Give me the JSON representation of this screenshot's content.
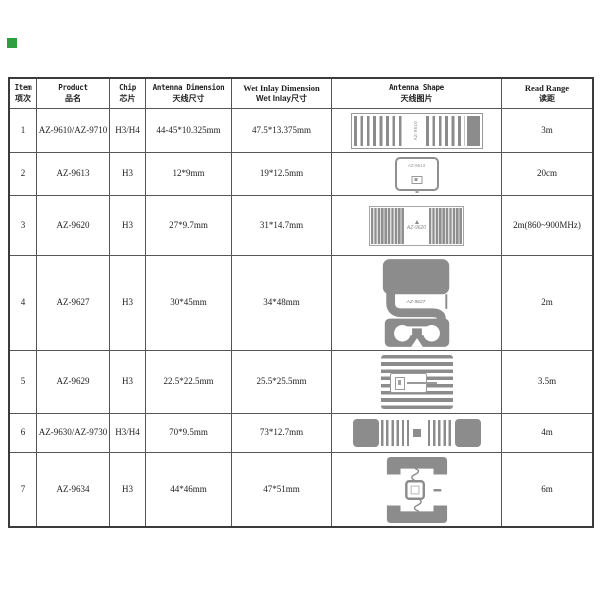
{
  "page": {
    "background": "#ffffff",
    "marker_color": "#2e9e40"
  },
  "table": {
    "headers": [
      {
        "en": "Item",
        "zh": "项次"
      },
      {
        "en": "Product",
        "zh": "品名"
      },
      {
        "en": "Chip",
        "zh": "芯片"
      },
      {
        "en": "Antenna Dimension",
        "zh": "天线尺寸"
      },
      {
        "en": "Wet Inlay Dimension",
        "zh": "Wet Inlay尺寸"
      },
      {
        "en": "Antenna Shape",
        "zh": "天线图片"
      },
      {
        "en": "Read Range",
        "zh": "读距"
      }
    ],
    "rows": [
      {
        "item": "1",
        "product": "AZ-9610/AZ-9710",
        "chip": "H3/H4",
        "antenna_dimension": "44-45*10.325mm",
        "wet_inlay_dimension": "47.5*13.375mm",
        "shape": "striped-dipole-inlay",
        "shape_label": "AZ-9610",
        "read_range": "3m"
      },
      {
        "item": "2",
        "product": "AZ-9613",
        "chip": "H3",
        "antenna_dimension": "12*9mm",
        "wet_inlay_dimension": "19*12.5mm",
        "shape": "small-rounded-square-tag",
        "shape_label": "AZ-9613",
        "read_range": "20cm"
      },
      {
        "item": "3",
        "product": "AZ-9620",
        "chip": "H3",
        "antenna_dimension": "27*9.7mm",
        "wet_inlay_dimension": "31*14.7mm",
        "shape": "dense-striped-rectangle",
        "shape_label": "AZ-9620",
        "read_range": "2m(860~900MHz)"
      },
      {
        "item": "4",
        "product": "AZ-9627",
        "chip": "H3",
        "antenna_dimension": "30*45mm",
        "wet_inlay_dimension": "34*48mm",
        "shape": "vertical-serpentine-tag",
        "shape_label": "AZ-9627",
        "read_range": "2m"
      },
      {
        "item": "5",
        "product": "AZ-9629",
        "chip": "H3",
        "antenna_dimension": "22.5*22.5mm",
        "wet_inlay_dimension": "25.5*25.5mm",
        "shape": "horizontal-striped-square",
        "shape_label": "",
        "read_range": "3.5m"
      },
      {
        "item": "6",
        "product": "AZ-9630/AZ-9730",
        "chip": "H3/H4",
        "antenna_dimension": "70*9.5mm",
        "wet_inlay_dimension": "73*12.7mm",
        "shape": "long-meander-dipole",
        "shape_label": "",
        "read_range": "4m"
      },
      {
        "item": "7",
        "product": "AZ-9634",
        "chip": "H3",
        "antenna_dimension": "44*46mm",
        "wet_inlay_dimension": "47*51mm",
        "shape": "square-bracket-tag",
        "shape_label": "",
        "read_range": "6m"
      }
    ]
  }
}
